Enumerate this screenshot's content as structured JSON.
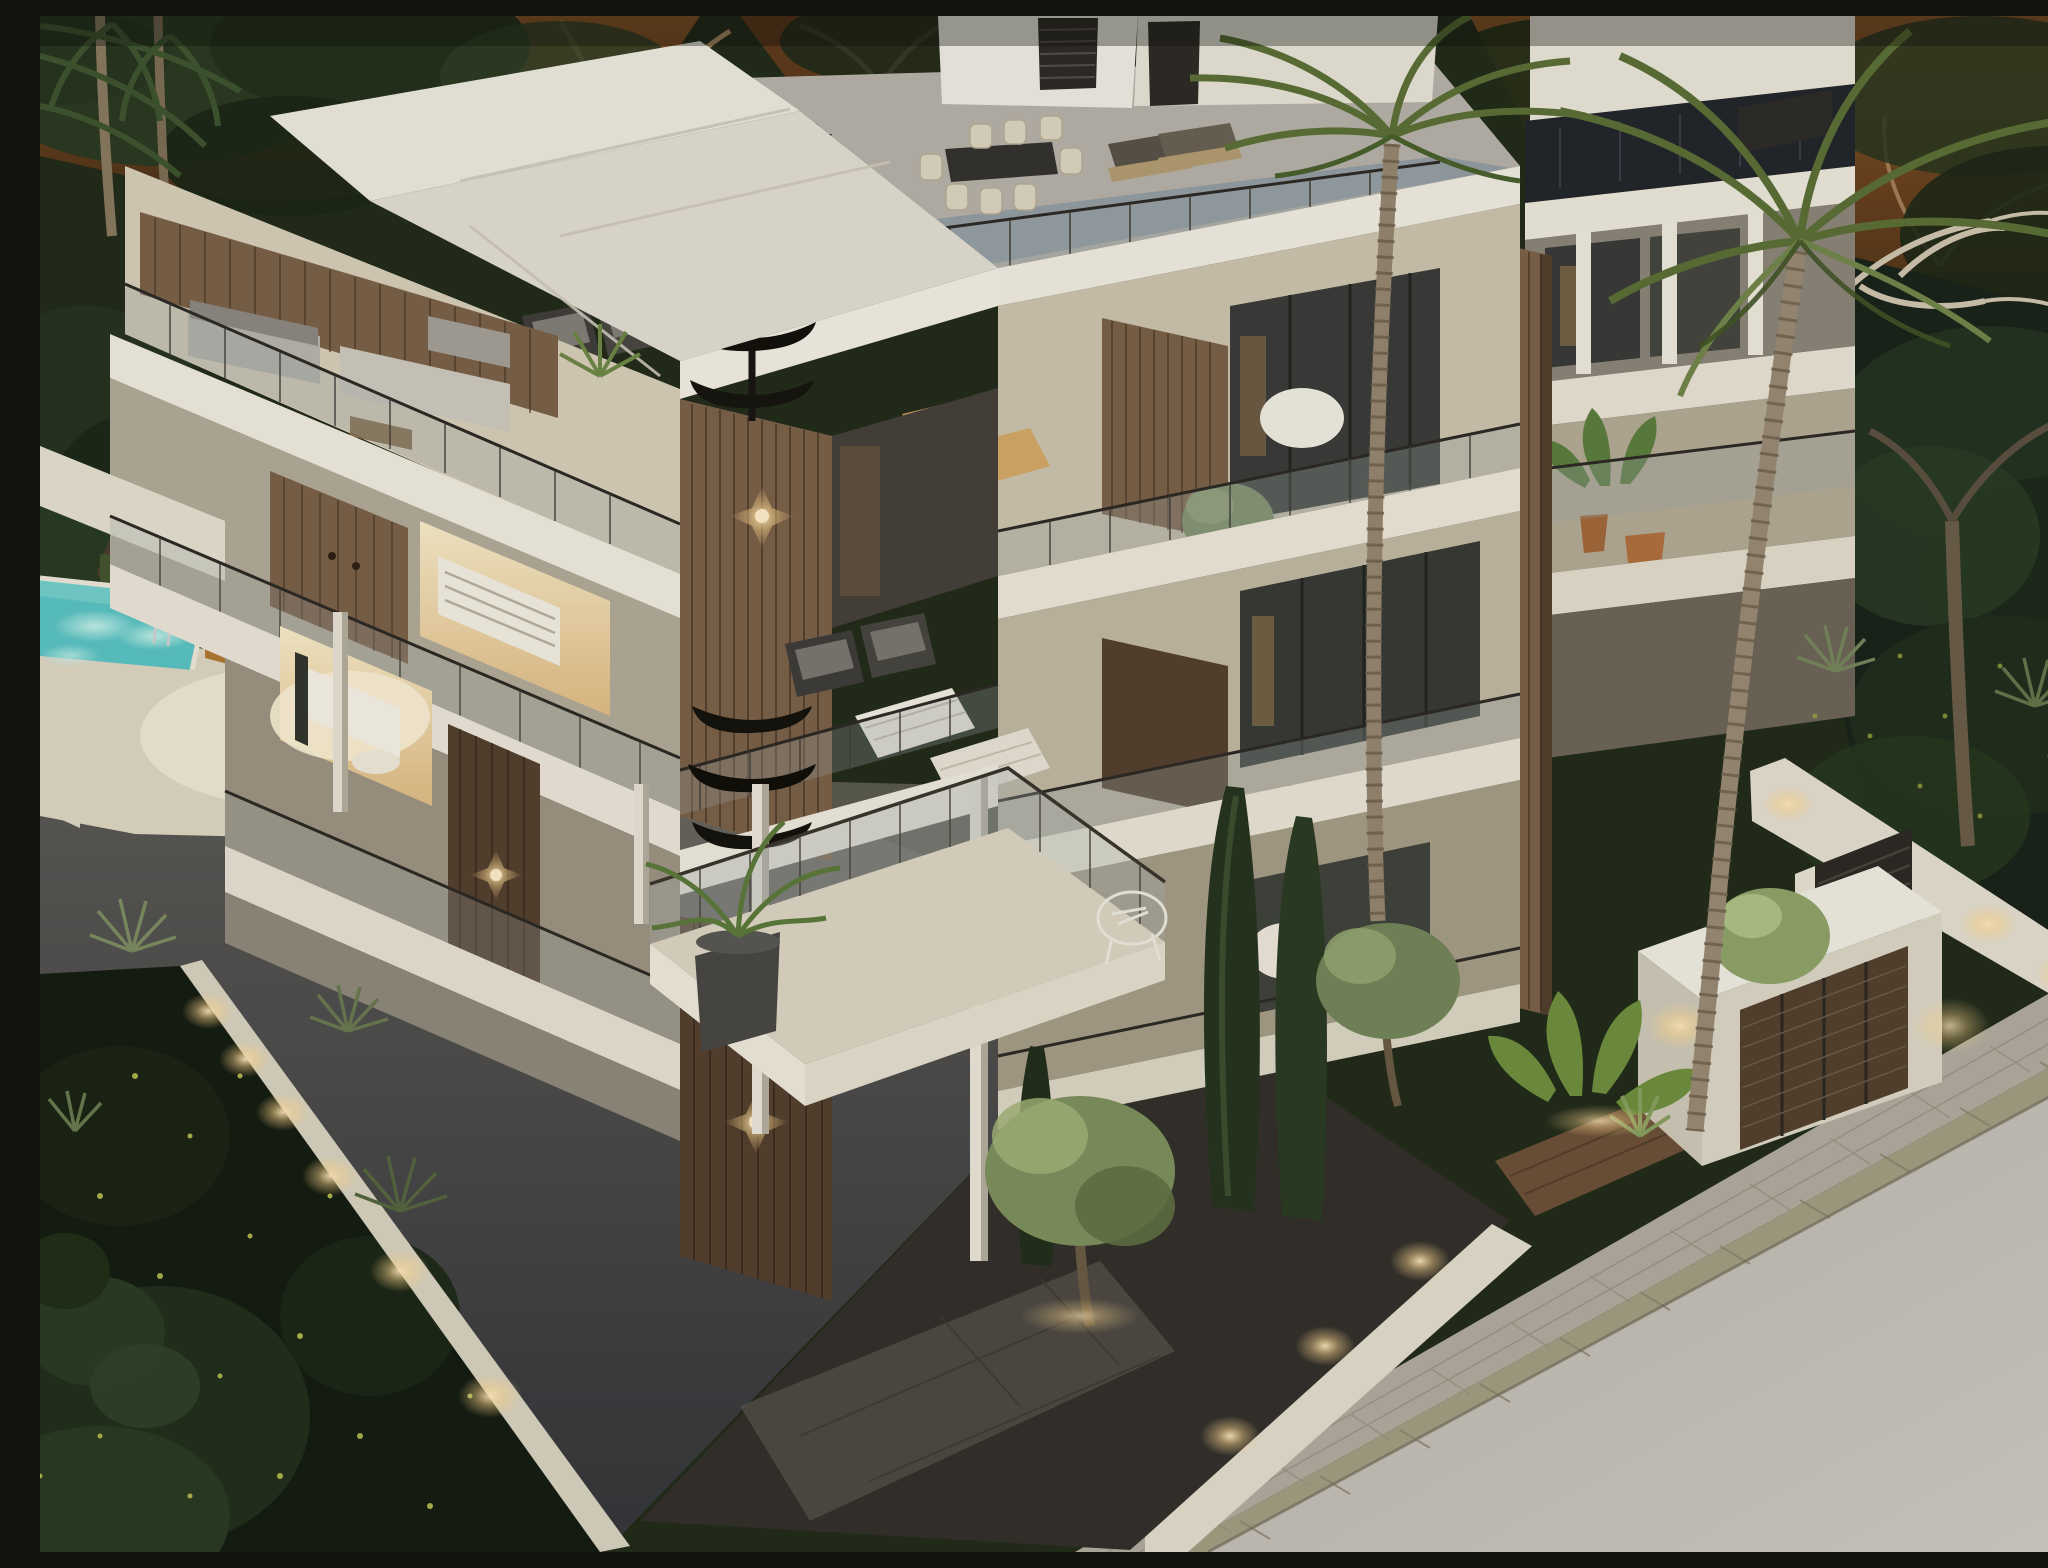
{
  "meta": {
    "type": "architectural-render",
    "caption": "Aerial dusk rendering of a modern white multi-storey apartment building with wood-slat accents, glass balconies, rooftop terrace with dining set and loungers, black spiral staircase, illuminated interiors, swimming pool, dark driveway ramp, landscaped gardens with palms and cypresses, boundary walls with warm accent lights, paved sidewalk and street",
    "time_of_day": "dusk"
  },
  "colors": {
    "foliage_base": "#232c1b",
    "foliage_dark": "#161d12",
    "dusk_orange": "#7a4a22",
    "building_white": "#f3efe4",
    "building_shadow": "#cfc8b8",
    "wood": "#7c6148",
    "wood_dark": "#55412f",
    "floor_cream": "#e9dfc8",
    "roof_terrace_floor": "#8e99a2",
    "glass_tint": "#9aa5a6",
    "window_dark": "#33352f",
    "interior_glow": "#f6e7c6",
    "sconce_light": "#ffe3a6",
    "pool_water": "#5cc4c4",
    "pool_glow": "#a5e4de",
    "deck": "#ddd6c2",
    "driveway": "#414246",
    "street": "#c7c2ba",
    "sidewalk": "#b2ac9f",
    "curb": "#a49e82",
    "garden_grass": "#4a5a33",
    "olive_green": "#7e905e",
    "cypress_green": "#26351f",
    "palm_green": "#5c7036",
    "trunk": "#95866f"
  },
  "scene": {
    "objects": [
      "apartment-building",
      "rooftop-terrace",
      "spiral-staircase",
      "dining-set",
      "sun-loungers",
      "balconies",
      "wood-slat-panels",
      "wall-sconces",
      "swimming-pool",
      "pool-deck",
      "driveway-ramp",
      "retaining-wall-lights",
      "front-garden",
      "cypress-trees",
      "olive-trees",
      "palm-trees",
      "boundary-walls",
      "entrance-gate",
      "garage",
      "sidewalk",
      "street"
    ]
  }
}
